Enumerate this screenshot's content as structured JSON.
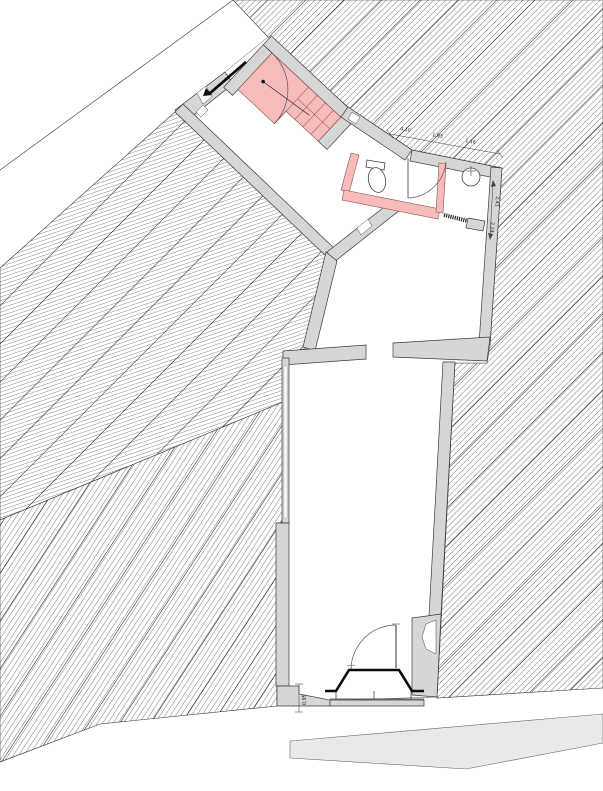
{
  "dimensions": {
    "top_chain": [
      "4,10",
      "1,93",
      "1,16"
    ],
    "right_chain": [
      "2,41",
      "2,24"
    ],
    "entrance": "0,95"
  },
  "colors": {
    "wall_fill": "#d6d6d6",
    "wall_stroke": "#3a3a3a",
    "stair_pink": "#f6bcbc",
    "pink_stroke": "#8f5151",
    "pavement": "#e9e9e9",
    "hatch_line": "#4a4a4a"
  }
}
